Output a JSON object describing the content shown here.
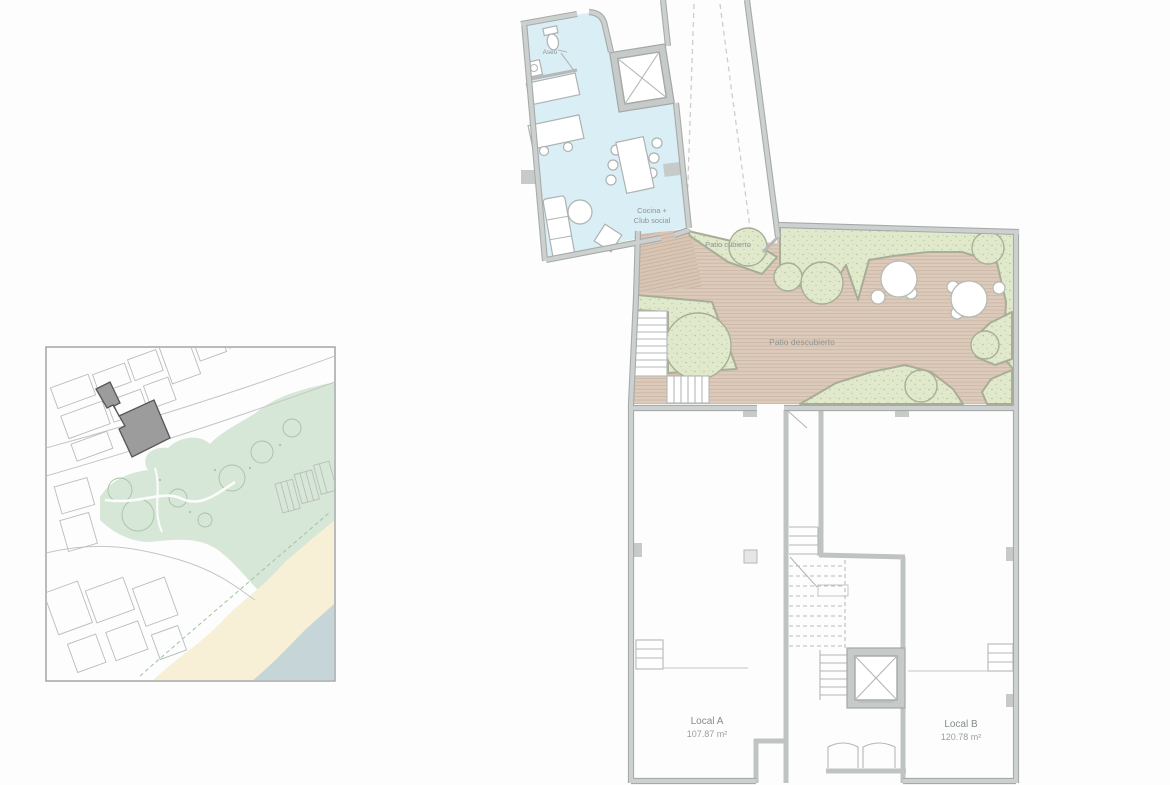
{
  "document": {
    "kind": "architectural-floor-plan",
    "description": "Ground/first floor plan with patios and site location inset map"
  },
  "plan": {
    "rooms": [
      {
        "id": "aseo",
        "label": "Aseo"
      },
      {
        "id": "cocina-club-social",
        "label_line1": "Cocina +",
        "label_line2": "Club social"
      },
      {
        "id": "patio-cubierto",
        "label": "Patio cubierto"
      },
      {
        "id": "patio-descubierto",
        "label": "Patio descubierto"
      }
    ],
    "units": [
      {
        "name": "Local A",
        "area": "107.87 m²"
      },
      {
        "name": "Local B",
        "area": "120.78 m²"
      }
    ],
    "symbols": [
      "elevator-x",
      "stairs",
      "door-swing",
      "dining-table",
      "sofa",
      "kitchen-island",
      "toilet",
      "parasol-table",
      "tree-bush"
    ]
  },
  "location_map": {
    "features": [
      "street-blocks",
      "main-road",
      "park-green",
      "beach-sand",
      "sea-water",
      "subject-building-highlight"
    ]
  },
  "colors": {
    "wall": "#c6cac8",
    "wall_edge": "#a6aba9",
    "room_blue": "#daeef6",
    "deck_tan": "#dccaba",
    "deck_stripe": "#cdb7a6",
    "green": "#e0e9cb",
    "map_park": "#d7e7d7",
    "map_sand": "#f7efd6",
    "map_sea": "#c6d5d7",
    "highlight_building": "#9c9c9c",
    "label_text": "#8f9493"
  }
}
